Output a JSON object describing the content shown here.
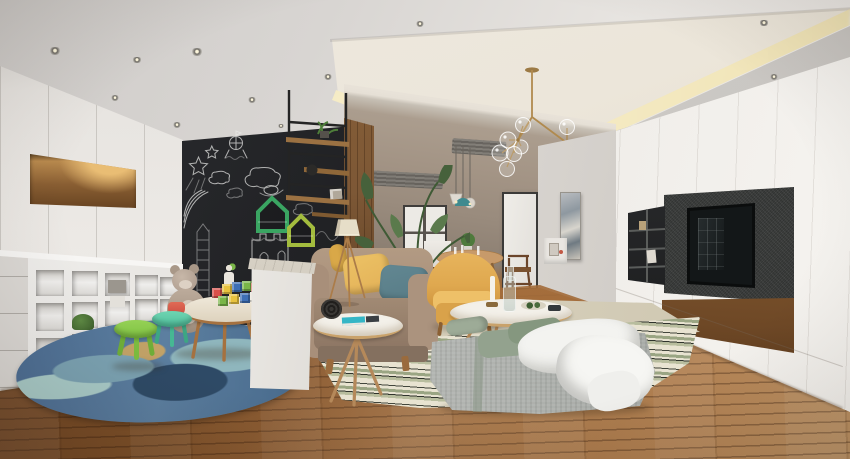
{
  "description": "3D rendering of a modern family living room: kids play corner with chalkboard wall and cubby storage on the left, beige sofa and gray daybed in the center under a brass globe chandelier, white TV media wall on the right, wood plank flooring.",
  "palette": {
    "ceilingA": "#cfccc9",
    "ceilingB": "#e9e6e2",
    "trayWarm": "#ece6da",
    "cove": "#f7eecb",
    "soffit": "#c9c6c2",
    "wallLeft": "#e7e4e0",
    "nicheWood": "#8a5f33",
    "nicheGlow": "#e9bd74",
    "chalk": "#26272a",
    "chalkLine": "#e9e9e7",
    "houseGreen": "#3aa562",
    "houseLime": "#a3bc3e",
    "woodCol": "#7d5836",
    "backWall": "#a39485",
    "hallWall": "#d8d4cf",
    "doorFrame": "#3f3d3b",
    "doorGlass": "#eceae5",
    "tvWallA": "#e3e0db",
    "tvWallB": "#f6f4f0",
    "tvPanel": "#3c3e3d",
    "tvScreen": "#131718",
    "cubbyBlack": "#27282a",
    "floorA": "#6b4222",
    "floorB": "#b8895a",
    "plankLine": "rgba(45,22,8,0.32)",
    "rugBlue": "#4d6e94",
    "rugBlueDeep": "#2e4a66",
    "rugAqua": "#8fb6bd",
    "rugTan": "#c2a267",
    "stripeCream": "#e8e3d1",
    "stripeSage": "#9aa583",
    "stripeDark": "#42463c",
    "beigeRug": "#d6cfba",
    "sofa": "#a88f79",
    "sofaDark": "#8d7664",
    "pillowYellow": "#e3b158",
    "pillowTeal": "#577b85",
    "shade": "#e6dec8",
    "woodLeg": "#b08350",
    "tableTop": "#f3f0e9",
    "tableRim": "#c9a26b",
    "armYellow": "#dfa84f",
    "ottoman": "#b2b5b1",
    "sage": "#93a28e",
    "blanket": "#f3f3f0",
    "stoolGreen": "#7fc242",
    "stoolTeal": "#4fc09c",
    "toyRed": "#cc4f43",
    "teddy": "#b3a294",
    "marble": "#d4cec2",
    "brass": "#b08a4e",
    "pendantTeal": "#3f8a8f",
    "plant": "#45603a"
  },
  "ceiling": {
    "spotlights": [
      [
        55,
        51,
        7
      ],
      [
        197,
        52,
        7
      ],
      [
        137,
        60,
        6
      ],
      [
        115,
        98,
        5
      ],
      [
        177,
        125,
        5
      ],
      [
        252,
        100,
        5
      ],
      [
        281,
        126,
        4
      ],
      [
        328,
        77,
        5
      ],
      [
        420,
        24,
        5
      ],
      [
        663,
        127,
        4
      ],
      [
        764,
        23,
        6
      ],
      [
        774,
        77,
        5
      ]
    ]
  },
  "kids_area": {
    "cubby_holes": [
      [
        36,
        270,
        28,
        26
      ],
      [
        72,
        271,
        26,
        25
      ],
      [
        105,
        273,
        25,
        23
      ],
      [
        135,
        275,
        23,
        21
      ],
      [
        160,
        277,
        19,
        19
      ],
      [
        36,
        303,
        28,
        28
      ],
      [
        72,
        302,
        26,
        26
      ],
      [
        105,
        301,
        25,
        25
      ],
      [
        135,
        299,
        23,
        23
      ],
      [
        160,
        299,
        19,
        20
      ],
      [
        36,
        338,
        28,
        30
      ],
      [
        72,
        334,
        26,
        28
      ],
      [
        105,
        330,
        25,
        27
      ],
      [
        135,
        326,
        23,
        25
      ],
      [
        160,
        322,
        19,
        22
      ]
    ],
    "blocks": [
      [
        212,
        288,
        "#d9504a"
      ],
      [
        222,
        284,
        "#e8c23e"
      ],
      [
        232,
        282,
        "#3e6fb5"
      ],
      [
        242,
        281,
        "#7ab648"
      ],
      [
        251,
        283,
        "#d9504a"
      ],
      [
        218,
        296,
        "#7ab648"
      ],
      [
        229,
        294,
        "#e8c23e"
      ],
      [
        240,
        293,
        "#3e6fb5"
      ],
      [
        250,
        292,
        "#e8e4da"
      ]
    ]
  },
  "scene_objects": [
    "recessed-ceiling-with-cove-lighting",
    "brass-globe-chandelier",
    "chalkboard-wall-with-chalk-doodles",
    "house-shaped-wall-shelves",
    "hanging-black-metal-shelf",
    "white-cubby-storage",
    "kids-round-table",
    "teddy-bear",
    "alphabet-blocks",
    "green-stool",
    "teal-stool",
    "blue-round-rug",
    "white-half-wall-partition",
    "beige-sofa",
    "tripod-floor-lamp",
    "round-side-table",
    "yellow-armchair",
    "round-coffee-table",
    "gray-daybed-with-white-throw",
    "striped-area-rug",
    "tv-media-wall",
    "wall-mounted-tv",
    "dining-table-with-pendant-lights",
    "glass-paneled-door",
    "wood-plank-floor",
    "indoor-plants"
  ]
}
